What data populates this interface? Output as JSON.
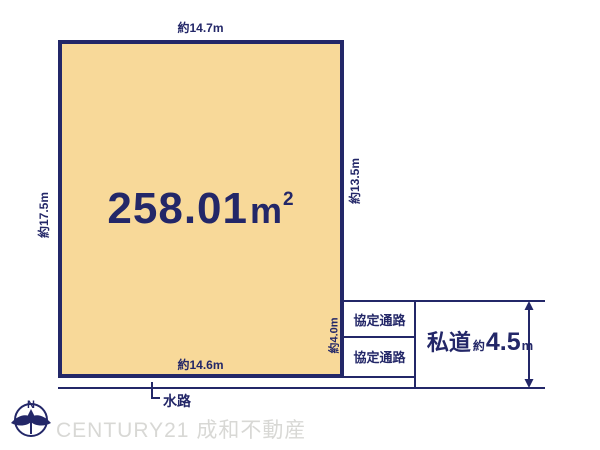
{
  "diagram": {
    "area": {
      "value": "258.01",
      "unit_base": "m",
      "unit_exponent": "2"
    },
    "dimensions": {
      "top": "約14.7m",
      "left": "約17.5m",
      "right": "約13.5m",
      "inner_right": "約4.0m",
      "bottom": "約14.6m"
    },
    "passages": {
      "upper": "協定通路",
      "lower": "協定通路"
    },
    "private_road": {
      "name": "私道",
      "approx": "約",
      "width_value": "4.5",
      "width_unit": "m"
    },
    "waterway_label": "水路",
    "compass_label": "N",
    "watermark": "CENTURY21 成和不動産",
    "colors": {
      "plot_fill": "#F8D999",
      "line_navy": "#232768",
      "watermark_gray": "#D8D8D5"
    }
  }
}
